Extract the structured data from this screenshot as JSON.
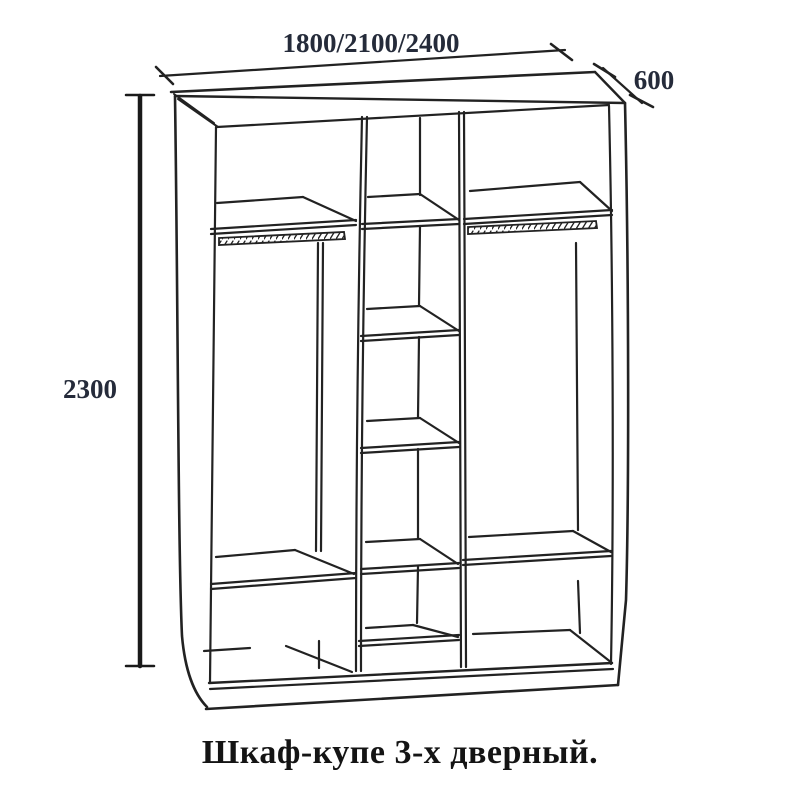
{
  "caption": {
    "text": "Шкаф-купе 3-х дверный."
  },
  "dimensions": {
    "width": {
      "label": "1800/2100/2400"
    },
    "depth": {
      "label": "600"
    },
    "height": {
      "label": "2300"
    }
  },
  "colors": {
    "line": "#222222",
    "dimension_text": "#252b3a",
    "caption_text": "#141414",
    "background": "#ffffff"
  }
}
